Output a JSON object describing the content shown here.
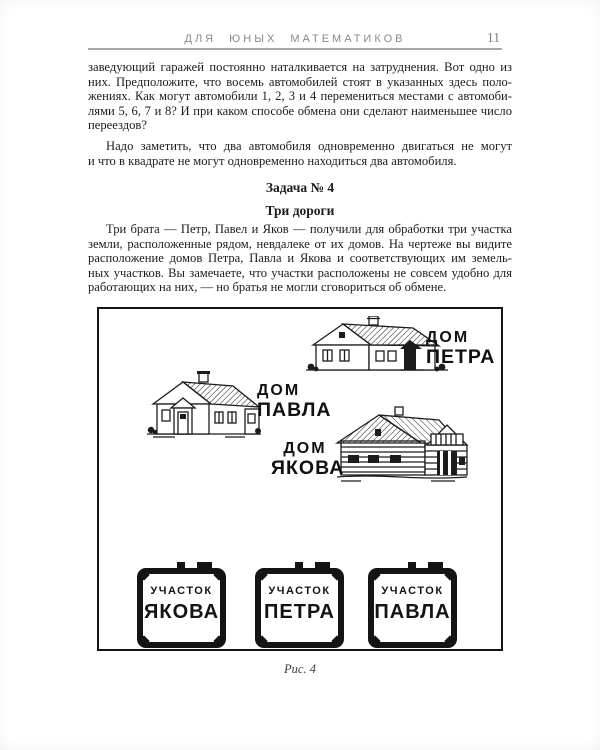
{
  "header": {
    "running_title": "ДЛЯ  ЮНЫХ  МАТЕМАТИКОВ",
    "page_number": "11"
  },
  "paragraph1": {
    "lines": [
      "заведующий гаражей постоянно наталкивается на затруднения. Вот одно из",
      "них. Предположите, что восемь автомобилей стоят в указанных здесь поло-",
      "жениях. Как могут автомобили 1, 2, 3 и 4 перемениться местами с автомоби-",
      "лями 5, 6, 7 и 8? И при каком способе обмена они сделают наименьшее число",
      "переездов?"
    ]
  },
  "paragraph2": {
    "lines": [
      "Надо заметить, что два автомобиля одновременно двигаться не могут",
      "и что в квадрате не могут одновременно находиться два автомобиля."
    ]
  },
  "problem": {
    "heading": "Задача № 4",
    "title": "Три дороги"
  },
  "paragraph3": {
    "lines": [
      "Три брата — Петр, Павел и Яков — получили для обработки три участка",
      "земли, расположенные рядом, невдалеке от их домов. На чертеже вы видите",
      "расположение домов Петра, Павла и Якова и соответствующих им земель-",
      "ных участков. Вы замечаете, что участки расположены не совсем удобно для",
      "работающих на них, — но братья не могли сговориться об обмене."
    ]
  },
  "figure": {
    "caption": "Рис. 4",
    "houses": [
      {
        "name": "petra",
        "label1": "ДОМ",
        "label2": "ПЕТРА"
      },
      {
        "name": "pavla",
        "label1": "ДОМ",
        "label2": "ПАВЛА"
      },
      {
        "name": "yakova",
        "label1": "ДОМ",
        "label2": "ЯКОВА"
      }
    ],
    "plots": [
      {
        "name": "yakova",
        "label1": "УЧАСТОК",
        "label2": "ЯКОВА"
      },
      {
        "name": "petra",
        "label1": "УЧАСТОК",
        "label2": "ПЕТРА"
      },
      {
        "name": "pavla",
        "label1": "УЧАСТОК",
        "label2": "ПАВЛА"
      }
    ]
  },
  "colors": {
    "ink": "#1c1c1c",
    "header_gray": "#8a8a8a",
    "rule_gray": "#a8a8a8"
  }
}
